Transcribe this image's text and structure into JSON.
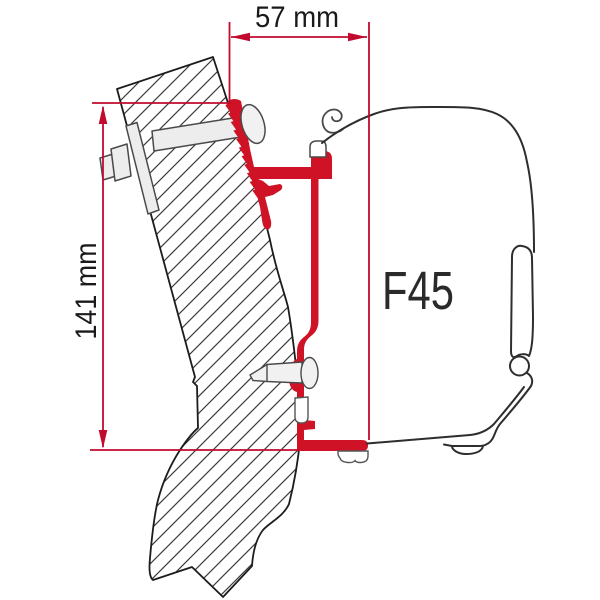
{
  "diagram": {
    "product_label": "F45",
    "dimensions": {
      "width": {
        "label": "57 mm",
        "value": 57,
        "unit": "mm"
      },
      "height": {
        "label": "141 mm",
        "value": 141,
        "unit": "mm"
      }
    },
    "colors": {
      "bracket_red": "#d01226",
      "dimension_red": "#c20a2e",
      "outline_dark": "#2e2e2e",
      "text_dark": "#1a1a1a",
      "metal_light": "#ededed",
      "background": "#ffffff"
    },
    "parts": {
      "wall": "vehicle-wall-cross-section",
      "adapter": "adapter-bracket",
      "awning_case": "awning-case-profile",
      "bolt": "mounting-bolt",
      "screw": "fixing-screw"
    }
  }
}
